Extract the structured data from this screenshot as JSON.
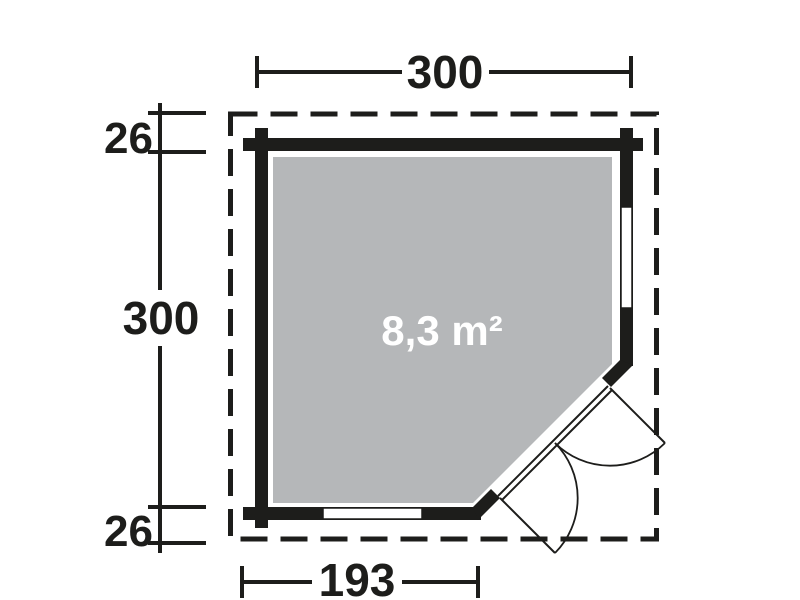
{
  "diagram": {
    "type": "floor-plan",
    "area_label": "8,3 m²",
    "dimensions": {
      "top_width": "300",
      "left_height": "300",
      "roof_overhang_top": "26",
      "roof_overhang_bottom": "26",
      "bottom_wall_width": "193"
    },
    "colors": {
      "wall": "#1d1d1b",
      "floor": "#b5b7b9",
      "area_text": "#ffffff",
      "background": "#ffffff"
    }
  }
}
